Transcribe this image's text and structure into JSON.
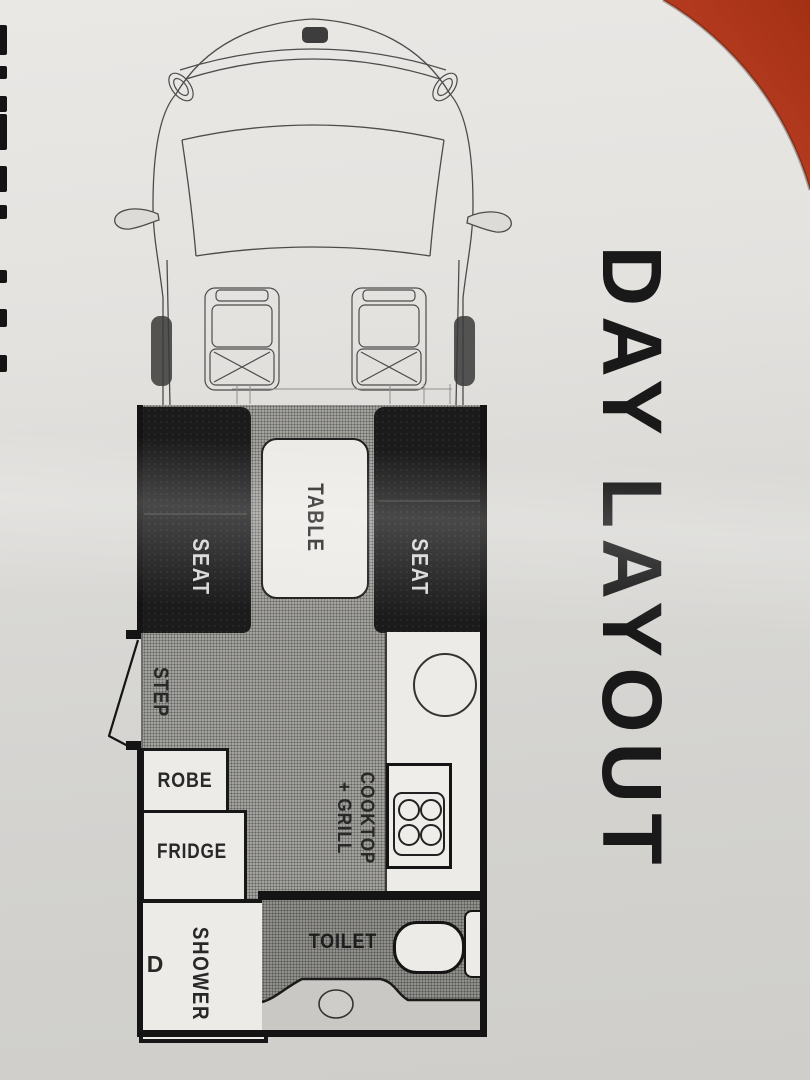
{
  "title": {
    "text": "DAY LAYOUT"
  },
  "floorplan": {
    "seat_left_label": "SEAT",
    "seat_right_label": "SEAT",
    "table_label": "TABLE",
    "step_label": "STEP",
    "robe_label": "ROBE",
    "fridge_label": "FRIDGE",
    "shower_label": "SHOWER",
    "shower_door_label": "D",
    "toilet_label": "TOILET",
    "cooktop_label_line1": "COOKTOP",
    "cooktop_label_line2": "+ GRILL"
  },
  "colors": {
    "accent_red": "#bb3a22",
    "accent_red_dark": "#9a2d16",
    "wall": "#141414",
    "seat": "#1b1b1b",
    "seat_text": "#d8d8d8",
    "floor": "#a2a19e",
    "floor_dot": "#63635f",
    "toilet_floor": "#908f8c",
    "toilet_dot": "#555552",
    "fixture": "#edebe7",
    "label_ink": "#282828",
    "title_ink": "#191919"
  }
}
